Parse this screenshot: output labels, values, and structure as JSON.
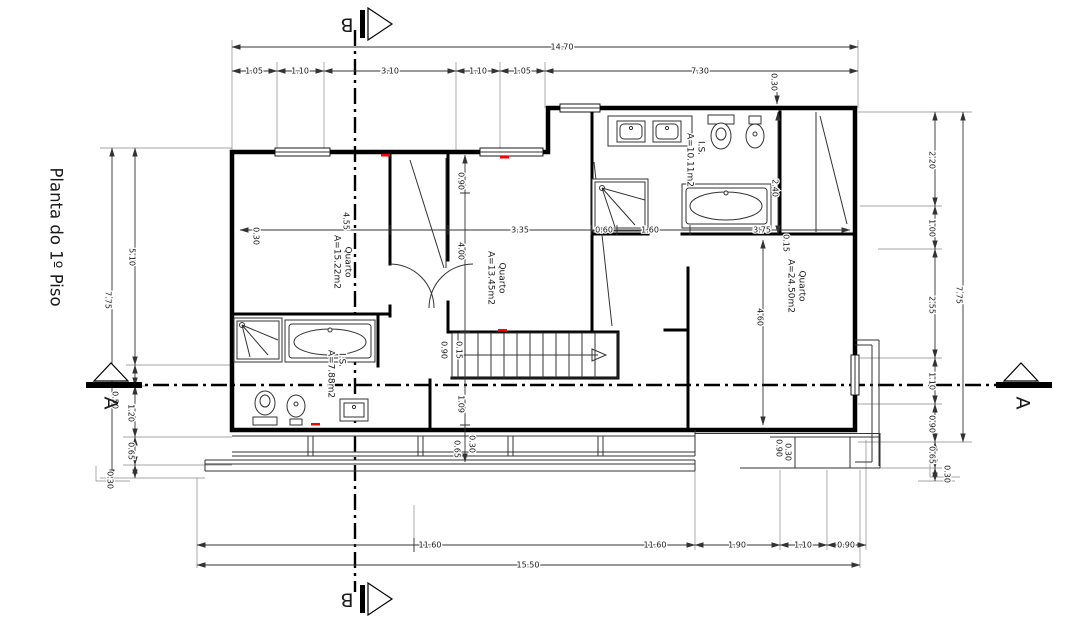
{
  "title": "Planta do 1º Piso",
  "sections": {
    "a": "A",
    "b": "B"
  },
  "rooms": [
    {
      "name": "Quarto",
      "area": "A=15.22m2"
    },
    {
      "name": "Quarto",
      "area": "A=13.45m2"
    },
    {
      "name": "Quarto",
      "area": "A=24.50m2"
    },
    {
      "name": "I.S.",
      "area": "A=10.11m2"
    },
    {
      "name": "I.S.",
      "area": "A=7.88m2"
    }
  ],
  "dim_labels": {
    "top_overall": "14.70",
    "top": [
      "1.05",
      "1.10",
      "3.10",
      "1.10",
      "1.05",
      "7.30"
    ],
    "top_wall": "0.30",
    "left_overall": "7.75",
    "left": [
      "5.10",
      "0.50",
      "1.20",
      "0.65",
      "0.30"
    ],
    "right_overall": "7.75",
    "right": [
      "2.20",
      "1.00",
      "2.55",
      "1.10",
      "0.90",
      "0.65",
      "0.30"
    ],
    "bottom": [
      "11.60",
      "11.60",
      "1.90",
      "1.10",
      "0.90"
    ],
    "bottom_overall": "15.50",
    "interior": [
      "0.30",
      "4.55",
      "0.90",
      "4.00",
      "3.35",
      "0.60",
      "1.60",
      "3.75",
      "0.15",
      "2.40",
      "4.60",
      "0.90",
      "0.15",
      "1.09",
      "0.65",
      "0.30",
      "0.90",
      "0.30"
    ]
  },
  "colors": {
    "wall": "#000000",
    "dimension": "#333333",
    "accent_red": "#ff0000",
    "background": "#ffffff"
  }
}
